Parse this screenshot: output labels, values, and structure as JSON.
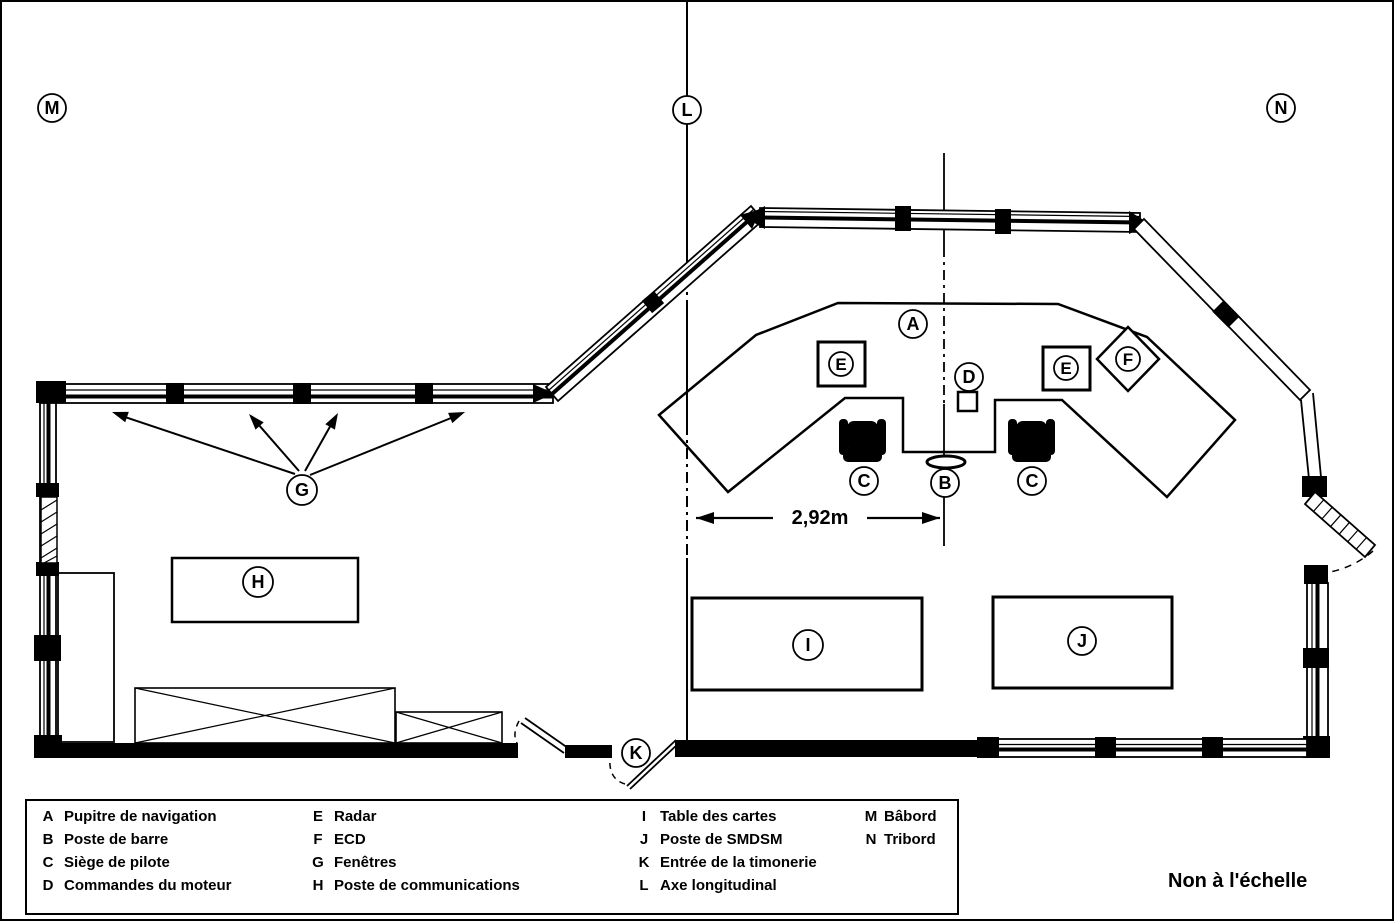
{
  "plan": {
    "dimension_label": "2,92m",
    "axis_letter": "L",
    "port_letter": "M",
    "starboard_letter": "N"
  },
  "legend": {
    "items": [
      {
        "key": "A",
        "label": "Pupitre de navigation"
      },
      {
        "key": "B",
        "label": "Poste de barre"
      },
      {
        "key": "C",
        "label": "Siège de pilote"
      },
      {
        "key": "D",
        "label": "Commandes du moteur"
      },
      {
        "key": "E",
        "label": "Radar"
      },
      {
        "key": "F",
        "label": "ECD"
      },
      {
        "key": "G",
        "label": "Fenêtres"
      },
      {
        "key": "H",
        "label": "Poste de communications"
      },
      {
        "key": "I",
        "label": "Table des cartes"
      },
      {
        "key": "J",
        "label": "Poste de SMDSM"
      },
      {
        "key": "K",
        "label": "Entrée de la timonerie"
      },
      {
        "key": "L",
        "label": "Axe longitudinal"
      },
      {
        "key": "M",
        "label": "Bâbord"
      },
      {
        "key": "N",
        "label": "Tribord"
      }
    ],
    "note": "Non à l'échelle"
  }
}
